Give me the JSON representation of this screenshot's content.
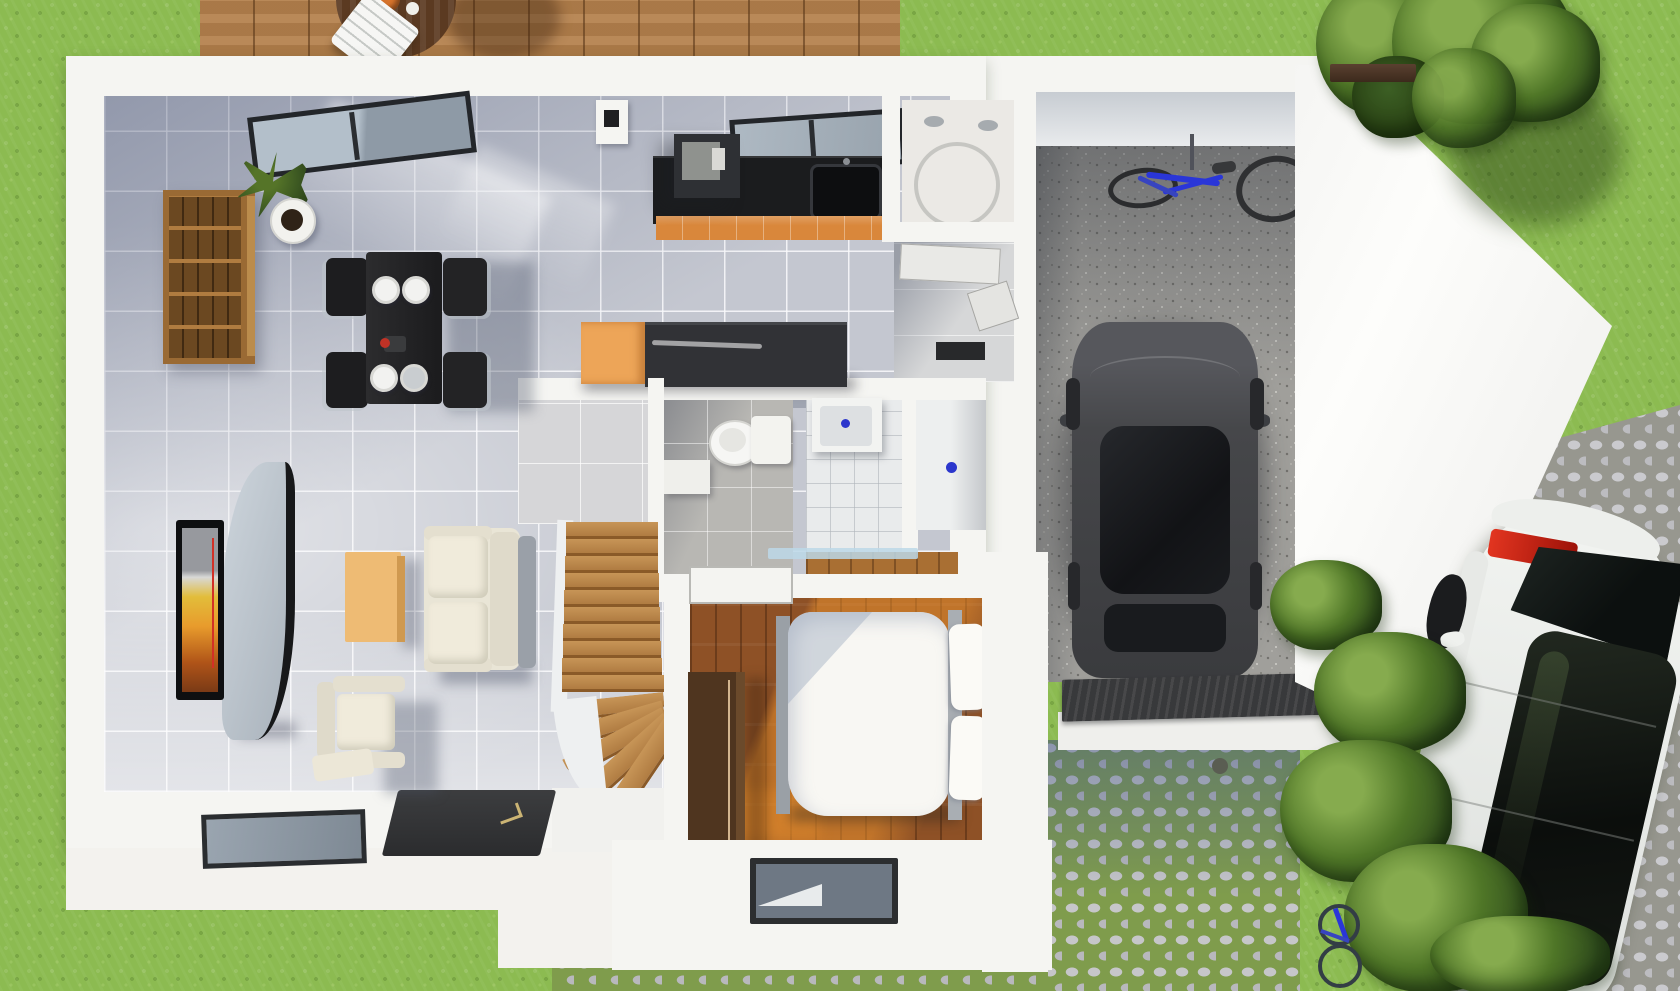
{
  "scene": {
    "type": "3d-floor-plan-render",
    "description": "Top-down 3D architectural rendering of a single-storey house with garage, deck, lawn, cobblestone driveway and two cars",
    "rooms": {
      "lawn": {
        "label": "Lawn"
      },
      "deck": {
        "label": "Wood deck with table and chair"
      },
      "living": {
        "label": "Living room"
      },
      "dining": {
        "label": "Dining area"
      },
      "kitchen": {
        "label": "Kitchen"
      },
      "utility": {
        "label": "Utility room with water heater"
      },
      "hallway": {
        "label": "Hallway"
      },
      "wc": {
        "label": "WC"
      },
      "bathroom": {
        "label": "Bathroom"
      },
      "shower": {
        "label": "Shower room"
      },
      "stairs": {
        "label": "Wooden staircase"
      },
      "bedroom": {
        "label": "Bedroom"
      },
      "garage": {
        "label": "Garage"
      },
      "driveway": {
        "label": "Cobblestone driveway"
      },
      "path": {
        "label": "Cobblestone front path"
      },
      "garden": {
        "label": "Garden bed with bushes"
      }
    },
    "furniture": {
      "deckTable": {
        "label": "Round deck table"
      },
      "deckChair": {
        "label": "White slatted deck chair"
      },
      "shelf": {
        "label": "Wooden cube shelving unit"
      },
      "plant": {
        "label": "Potted plant"
      },
      "slidingDoor": {
        "label": "Sliding glass door"
      },
      "diningTable": {
        "label": "Black dining table with four chairs and plates"
      },
      "tv": {
        "label": "Wall-mounted TV"
      },
      "tvStand": {
        "label": "Curved TV stand"
      },
      "coffeeTable": {
        "label": "Wooden coffee table"
      },
      "sofa": {
        "label": "Cream two-seat sofa"
      },
      "armchair": {
        "label": "Cream armchair with footstool"
      },
      "counter": {
        "label": "Kitchen counter with sink"
      },
      "island": {
        "label": "Kitchen island"
      },
      "appliance": {
        "label": "Kitchen appliance"
      },
      "waterHeater": {
        "label": "Cylindrical water heater"
      },
      "toilet": {
        "label": "Toilet"
      },
      "bathSink": {
        "label": "Bathroom sink"
      },
      "bed": {
        "label": "Double bed with pillows"
      },
      "wardrobe": {
        "label": "Dark wood wardrobe"
      },
      "garageCar": {
        "label": "Dark car parked in garage"
      },
      "bike": {
        "label": "Blue bicycle hung on garage wall"
      },
      "whiteCar": {
        "label": "White car parked on front path"
      },
      "smallBike": {
        "label": "Small bicycle in garden"
      },
      "tree": {
        "label": "Tree"
      },
      "doorMat": {
        "label": "Dark entry door panel"
      },
      "southWindow": {
        "label": "South window"
      }
    }
  },
  "palette": {
    "grass": "#8cbb51",
    "grassDark": "#76a33e",
    "deckWood": "#b5824e",
    "deckDark": "#5b3a21",
    "wall": "#f5f5f2",
    "wallShade": "#e2e2df",
    "tile": "#c4c7d0",
    "grout": "#f0f1f3",
    "counter": "#1b1c1e",
    "cabinet": "#d9873b",
    "island": "#313236",
    "islandCap": "#eda558",
    "bathTile": "#e9ebec",
    "wcFloor": "#b8b7b3",
    "woodFloor": "#8e5126",
    "hallWood": "#a96f33",
    "stairWood": "#c79557",
    "stairRiser": "#8a5a28",
    "bedWhite": "#f8f7f3",
    "bedFrame": "#9aa0a6",
    "wardrobe": "#4f351f",
    "gravel": "#a09f9b",
    "mat": "#38393b",
    "garageCar": "#46474a",
    "carGlass": "#1d1f23",
    "cobble": "#c6c6c9",
    "cobbleJointGrass": "#7f9c4c",
    "cobbleJointGray": "#97978f",
    "whiteCar": "#eef0ed",
    "taillight": "#d42718",
    "leafDark": "#2e4a1c",
    "leaf": "#4f7627",
    "leafLight": "#86ab4e",
    "blue": "#2b36cc",
    "bikeBlue": "#2a36d8",
    "sofa": "#e9e5d6",
    "tableWood": "#eebb74",
    "plate": "#f2f2f0"
  }
}
